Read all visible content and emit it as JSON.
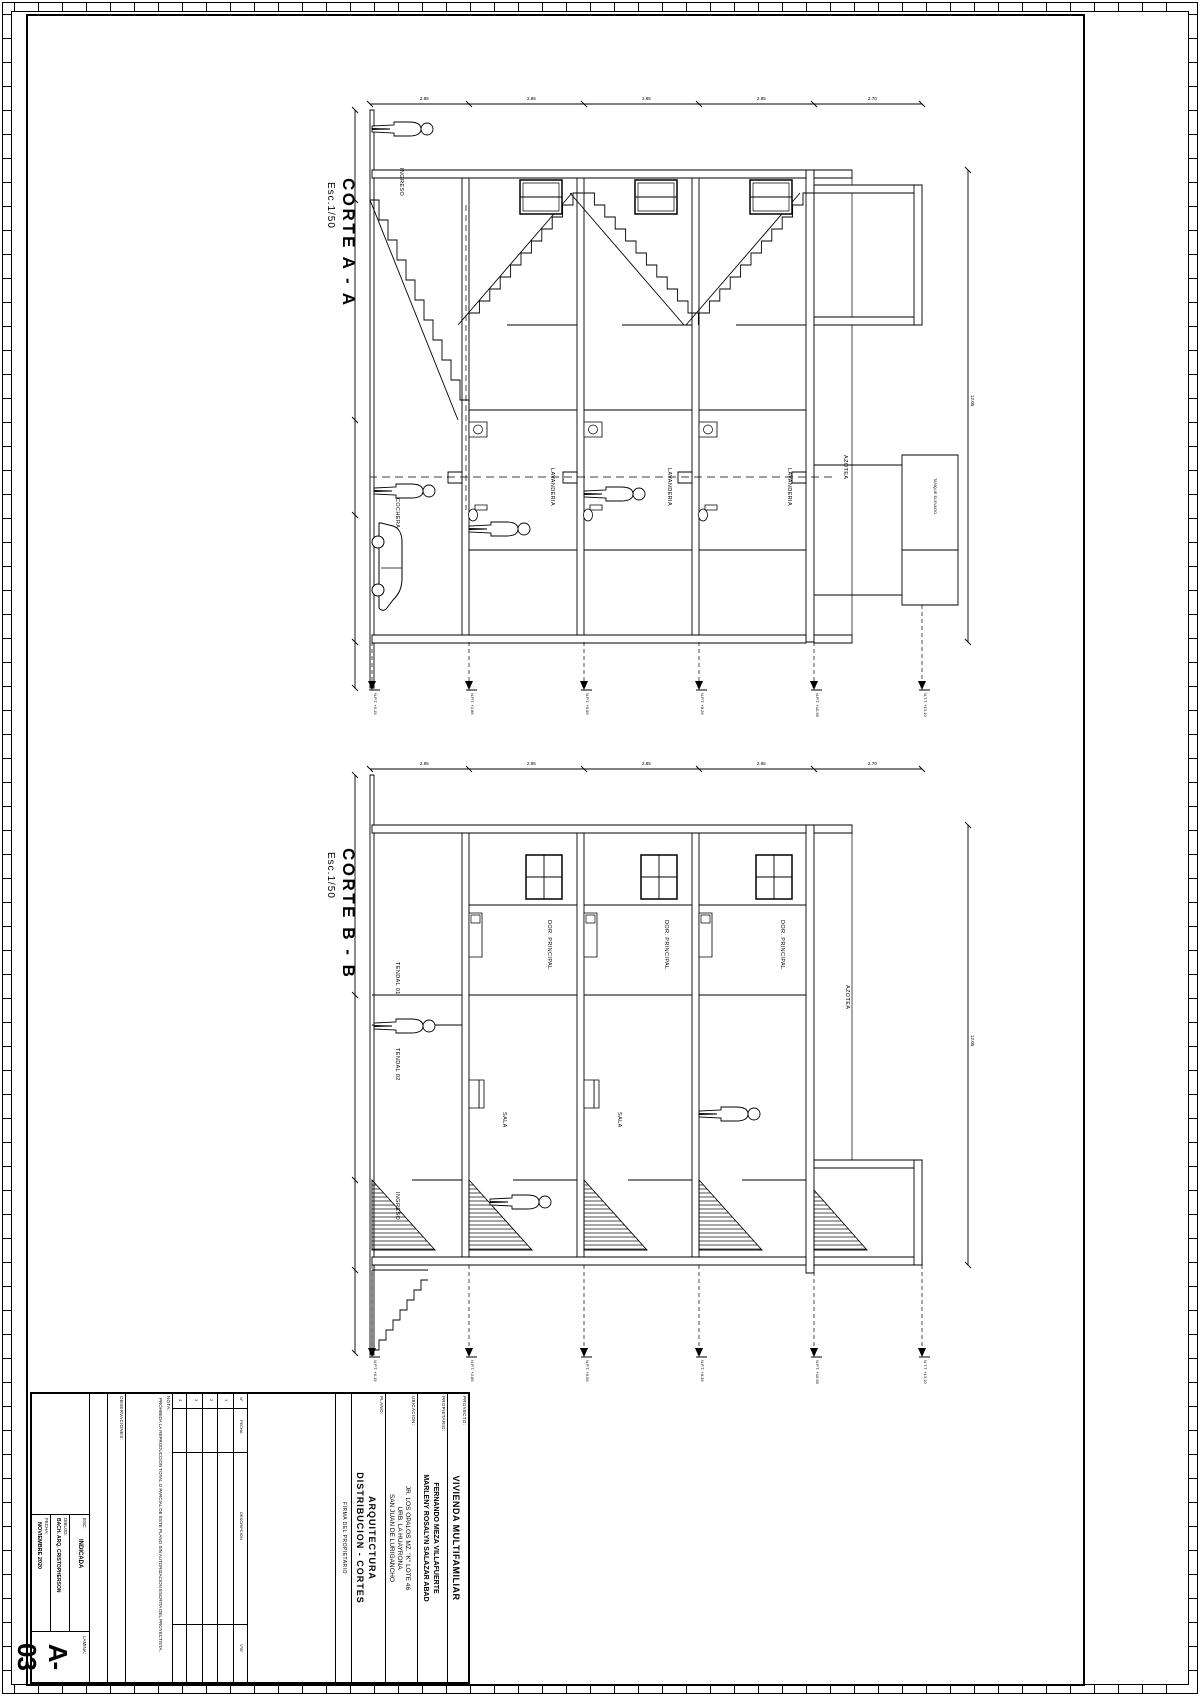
{
  "sections": {
    "a": {
      "title": "CORTE A - A",
      "scale": "Esc.1/50",
      "rooms": {
        "ingreso": "INGRESO",
        "cochera": "COCHERA",
        "lav": "LAVANDERIA",
        "azotea": "AZOTEA",
        "tanque": "TANQUE ELEVADO"
      }
    },
    "b": {
      "title": "CORTE B - B",
      "scale": "Esc.1/50",
      "rooms": {
        "dor": "DOR. PRINCIPAL",
        "sala": "SALA",
        "tendal1": "TENDAL 01",
        "tendal2": "TENDAL 02",
        "azotea": "AZOTEA",
        "ingreso": "INGRESO"
      }
    }
  },
  "levels": [
    "N.P.T. +0.15",
    "N.P.T. +2.85",
    "N.P.T. +5.55",
    "N.P.T. +8.25",
    "N.P.T. +10.95",
    "N.T.T. +13.10"
  ],
  "dims": {
    "h": [
      "2.70",
      "2.85",
      "2.85",
      "2.85",
      "2.85"
    ],
    "total_a": "12.05",
    "total_b": "12.05"
  },
  "titleblock": {
    "proyecto_label": "PROYECTO:",
    "proyecto": "VIVIENDA MULTIFAMILIAR",
    "propietario_label": "PROPIETARIO:",
    "prop1": "FERNANDO MEZA VILLAFUERTE",
    "prop2": "MARLENY ROSALYN SALAZAR ABAD",
    "ubicacion_label": "UBICACION:",
    "ubi1": "JR. LOS OPALOS MZ. \"K\" LOTE 46",
    "ubi2": "URB. LA HUAYRONA",
    "ubi3": "SAN JUAN DE LURIGANCHO",
    "plano_label": "PLANO:",
    "plano1": "ARQUITECTURA",
    "plano2": "DISTRIBUCION - CORTES",
    "firma_label": "FIRMA DEL PROPIETARIO",
    "rev_cols": {
      "num": "N°",
      "fecha": "FECHA",
      "desc": "DESCRIPCION",
      "vb": "V°B°"
    },
    "rev_rows": [
      "1",
      "2",
      "3",
      "4"
    ],
    "nota_label": "NOTA:",
    "nota": "PROHIBIDA LA REPRODUCCION TOTAL O PARCIAL DE ESTE PLANO SIN AUTORIZACION ESCRITA DEL PROYECTISTA.",
    "obs_label": "OBSERVACIONES:",
    "esc_label": "ESC:",
    "esc": "INDICADA",
    "dibujo_label": "DIBUJO:",
    "dibujo": "BACH. ARQ. CRISTOPHERSON",
    "fecha_label": "FECHA:",
    "fecha": "NOVIEMBRE 2020",
    "lamina_label": "LAMINA:",
    "lamina": "A-03"
  }
}
